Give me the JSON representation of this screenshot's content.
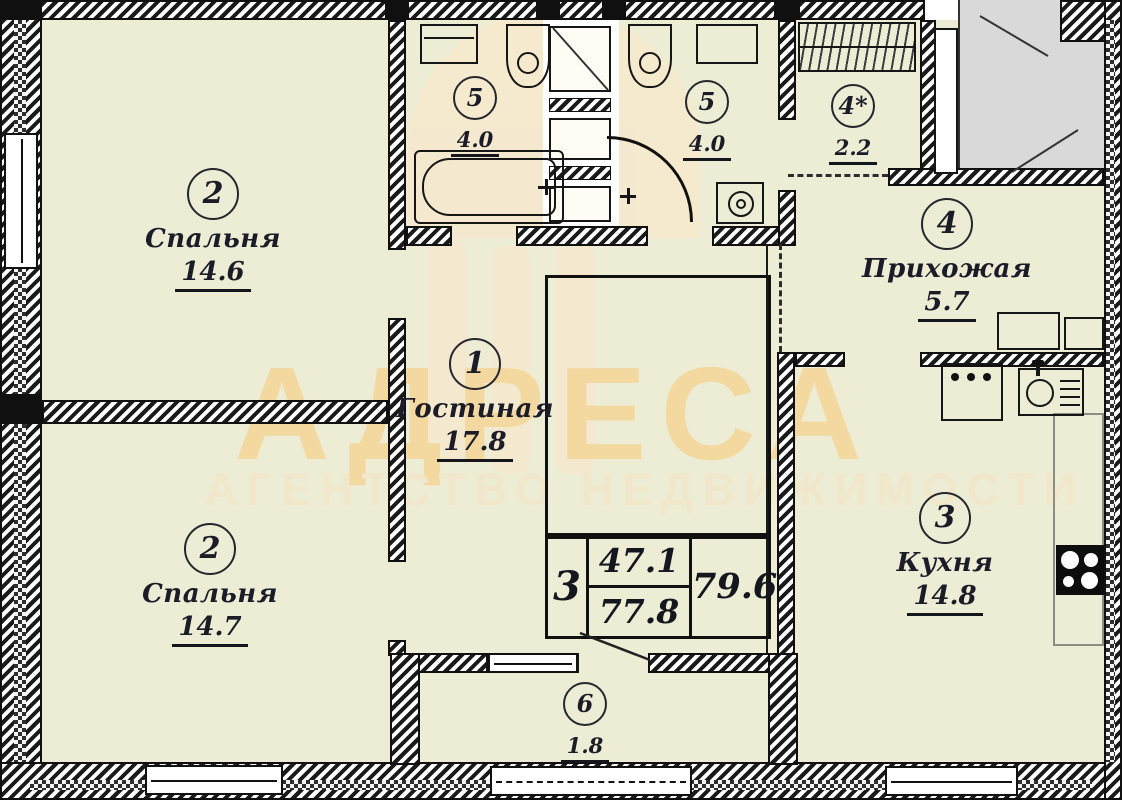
{
  "watermark": {
    "brand": "АДРЕСА",
    "tagline": "АГЕНТСТВО НЕДВИЖИМОСТИ"
  },
  "rooms": [
    {
      "id": "bedroom-1",
      "number": "2",
      "name": "Спальня",
      "area": "14.6"
    },
    {
      "id": "bedroom-2",
      "number": "2",
      "name": "Спальня",
      "area": "14.7"
    },
    {
      "id": "bathroom-left",
      "number": "5",
      "name": "",
      "area": "4.0"
    },
    {
      "id": "bathroom-right",
      "number": "5",
      "name": "",
      "area": "4.0"
    },
    {
      "id": "closet",
      "number": "4*",
      "name": "",
      "area": "2.2"
    },
    {
      "id": "hallway",
      "number": "4",
      "name": "Прихожая",
      "area": "5.7"
    },
    {
      "id": "living-room",
      "number": "1",
      "name": "Гостиная",
      "area": "17.8"
    },
    {
      "id": "kitchen",
      "number": "3",
      "name": "Кухня",
      "area": "14.8"
    },
    {
      "id": "balcony",
      "number": "6",
      "name": "",
      "area": "1.8"
    }
  ],
  "stamp": {
    "rooms_count": "3",
    "living_area": "47.1",
    "total_area": "77.8",
    "overall_area": "79.6"
  },
  "colors": {
    "room_fill": "#edecd4",
    "watermark_brand": "#f3d89f",
    "watermark_tagline": "#f1e7cb",
    "stairwell_fill": "#d9d9d9",
    "line": "#141414"
  }
}
